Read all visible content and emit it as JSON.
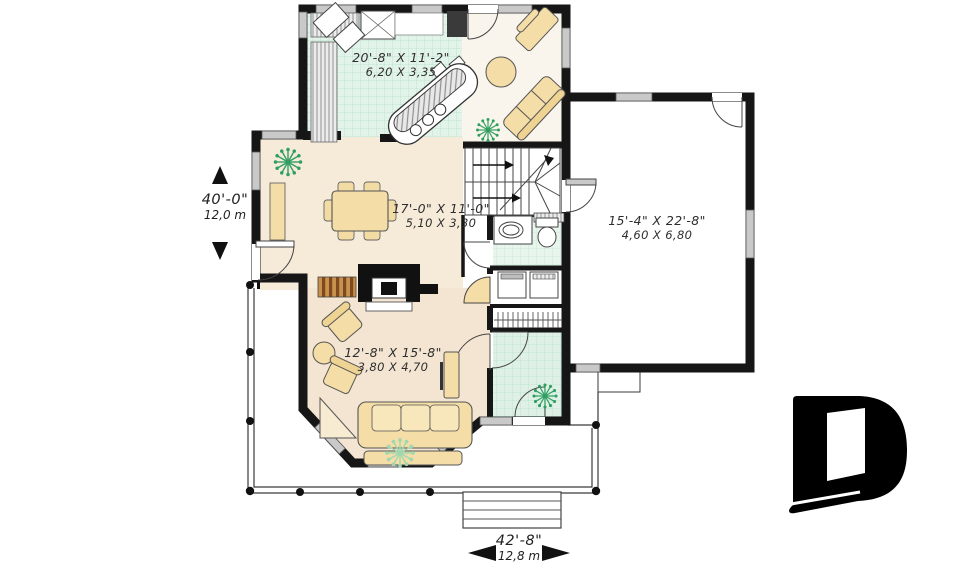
{
  "plan": {
    "rooms": {
      "kitchen": {
        "imperial": "20'-8\" X 11'-2\"",
        "metric": "6,20 X 3,35"
      },
      "dining": {
        "imperial": "17'-0\" X 11'-0\"",
        "metric": "5,10 X 3,30"
      },
      "garage": {
        "imperial": "15'-4\" X 22'-8\"",
        "metric": "4,60 X 6,80"
      },
      "living": {
        "imperial": "12'-8\" X 15'-8\"",
        "metric": "3,80 X 4,70"
      }
    },
    "overall": {
      "depth_imperial": "40'-0\"",
      "depth_metric": "12,0 m",
      "width_imperial": "42'-8\"",
      "width_metric": "12,8 m"
    },
    "colors": {
      "wall": "#161616",
      "tile_floor": "#dff1e7",
      "wood_floor": "#f5e9d6",
      "furniture": "#f4dda6",
      "plant_dark": "#2f9e60",
      "plant_light": "#9fd8b0",
      "logo": "#000000"
    }
  }
}
